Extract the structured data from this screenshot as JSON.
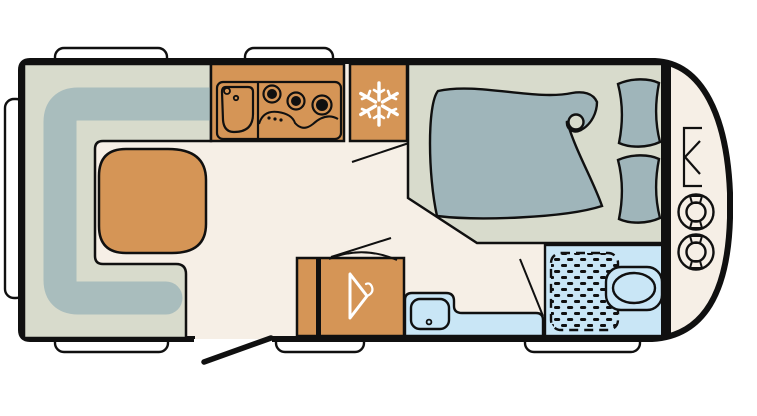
{
  "diagram": {
    "kind": "caravan-floor-plan",
    "orientation": "side-view-top-down, entrance door at bottom, towing nose at right"
  },
  "colors": {
    "outline": "#101010",
    "floor": "#F6EFE6",
    "seat_base": "#D8DBCC",
    "cushion": "#A9BDBD",
    "bedding": "#9FB5BA",
    "wood": "#D59556",
    "water": "#C9E6F6",
    "window_white": "#FFFFFF",
    "icon_white": "#FFFFFF"
  },
  "features": {
    "lounge": "U-shaped lounge seating with cushions",
    "table": "lounge table",
    "kitchen": "kitchen block with sink and 3-burner hob",
    "fridge": "refrigerator marked with snowflake-icon",
    "wardrobe": "wardrobe marked with clothes-hanger-icon",
    "washbasin": "washbasin cabinet",
    "bathroom": "washroom with shower tray and toilet",
    "bed": "french double bed with duvet and two pillows",
    "front_locker": "front gas locker with two gas-bottle-icons",
    "entry_door": "entrance door shown open",
    "windows": "2 top windows, 3 bottom windows, 1 rear window"
  }
}
